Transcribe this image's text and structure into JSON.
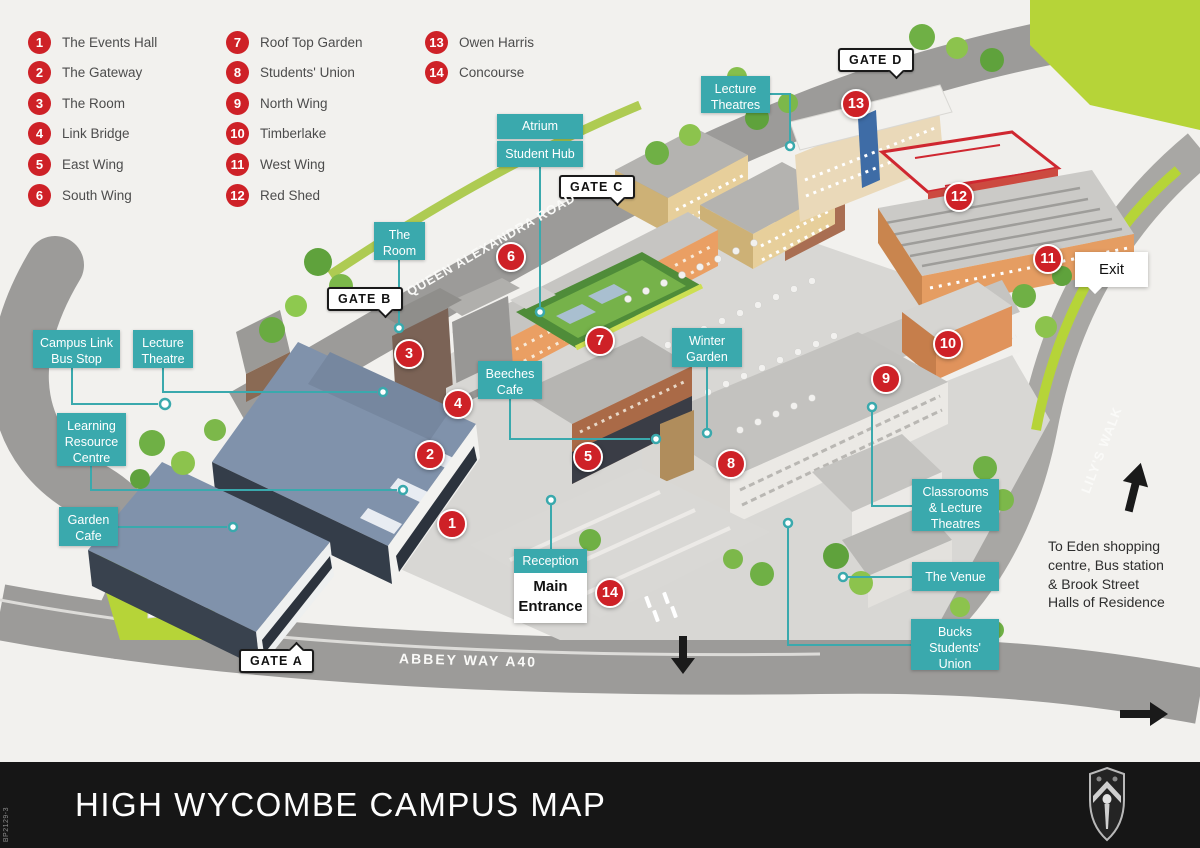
{
  "legend": {
    "items": [
      {
        "number": "1",
        "label": "The Events Hall"
      },
      {
        "number": "2",
        "label": "The Gateway"
      },
      {
        "number": "3",
        "label": "The Room"
      },
      {
        "number": "4",
        "label": "Link Bridge"
      },
      {
        "number": "5",
        "label": "East Wing"
      },
      {
        "number": "6",
        "label": "South Wing"
      },
      {
        "number": "7",
        "label": "Roof Top Garden"
      },
      {
        "number": "8",
        "label": "Students' Union"
      },
      {
        "number": "9",
        "label": "North Wing"
      },
      {
        "number": "10",
        "label": "Timberlake"
      },
      {
        "number": "11",
        "label": "West Wing"
      },
      {
        "number": "12",
        "label": "Red Shed"
      },
      {
        "number": "13",
        "label": "Owen Harris"
      },
      {
        "number": "14",
        "label": "Concourse"
      }
    ]
  },
  "map": {
    "labels": {
      "lecture_theatres_top": "Lecture\nTheatres",
      "atrium": "Atrium",
      "student_hub": "Student Hub",
      "the_room": "The\nRoom",
      "campus_link_bus_stop": "Campus Link\nBus Stop",
      "lecture_theatre_left": "Lecture\nTheatre",
      "learning_resource_centre": "Learning\nResource\nCentre",
      "garden_cafe": "Garden\nCafe",
      "beeches_cafe": "Beeches\nCafe",
      "winter_garden": "Winter\nGarden",
      "classrooms_lecture_theatres": "Classrooms\n& Lecture\nTheatres",
      "the_venue": "The Venue",
      "bucks_students_union": "Bucks\nStudents'\nUnion",
      "reception": "Reception",
      "main_entrance": "Main\nEntrance",
      "exit": "Exit"
    },
    "gates": {
      "a": "GATE A",
      "b": "GATE B",
      "c": "GATE C",
      "d": "GATE D"
    },
    "roads": {
      "queen_alexandra": "QUEEN ALEXANDRA ROAD",
      "abbey_way": "ABBEY WAY A40",
      "lilys_walk": "LILY'S WALK"
    },
    "note_eden": "To Eden shopping\ncentre, Bus station\n& Brook Street\nHalls of Residence",
    "markers": [
      {
        "number": "1"
      },
      {
        "number": "2"
      },
      {
        "number": "3"
      },
      {
        "number": "4"
      },
      {
        "number": "5"
      },
      {
        "number": "6"
      },
      {
        "number": "7"
      },
      {
        "number": "8"
      },
      {
        "number": "9"
      },
      {
        "number": "10"
      },
      {
        "number": "11"
      },
      {
        "number": "12"
      },
      {
        "number": "13"
      },
      {
        "number": "14"
      }
    ]
  },
  "footer": {
    "title": "HIGH WYCOMBE CAMPUS MAP",
    "code": "BP2129-3"
  },
  "colors": {
    "accent_teal": "#3AA9AD",
    "marker_red": "#CE2127",
    "footer_black": "#161616"
  }
}
